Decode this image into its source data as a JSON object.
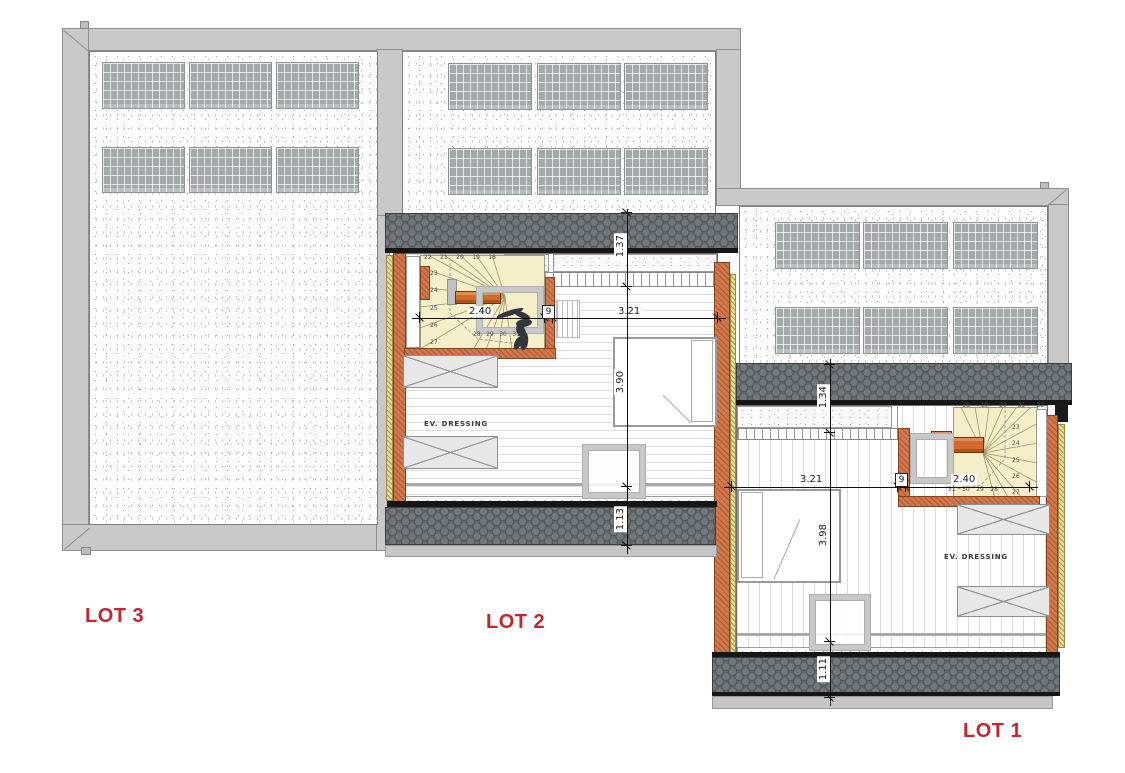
{
  "title": "Attic floor plan — LOT 1 / LOT 2 / LOT 3",
  "colors": {
    "accent_red": "#c2272d",
    "wall_orange": "#d1794e",
    "insulation_yellow": "#e7dc96",
    "stair_fill": "#f4efc9",
    "tile_gray": "#62666a"
  },
  "lot3": {
    "label": "LOT 3",
    "solar_panels": 6
  },
  "lot2": {
    "label": "LOT 2",
    "room_label": "EV. DRESSING",
    "solar_panels": 6,
    "dims": {
      "roof_top": "1.37",
      "stair_width": "2.40",
      "wall": "9",
      "room_width": "3.21",
      "room_depth": "3.90",
      "roof_bottom": "1.13"
    },
    "stairs": {
      "top": [
        "22",
        "21",
        "20",
        "19",
        "18"
      ],
      "left": [
        "23",
        "24",
        "25",
        "26",
        "27"
      ],
      "bottom": [
        "28",
        "29",
        "30",
        "31"
      ]
    }
  },
  "lot1": {
    "label": "LOT 1",
    "room_label": "EV. DRESSING",
    "solar_panels": 6,
    "dims": {
      "roof_top": "1.34",
      "room_width": "3.21",
      "wall": "9",
      "stair_width": "2.40",
      "room_depth": "3.98",
      "roof_bottom": "1.11"
    },
    "stairs": {
      "top": [
        "18",
        "19",
        "20",
        "21",
        "22"
      ],
      "right": [
        "23",
        "24",
        "25",
        "26",
        "27"
      ],
      "bottom": [
        "31",
        "30",
        "29",
        "28"
      ]
    }
  }
}
